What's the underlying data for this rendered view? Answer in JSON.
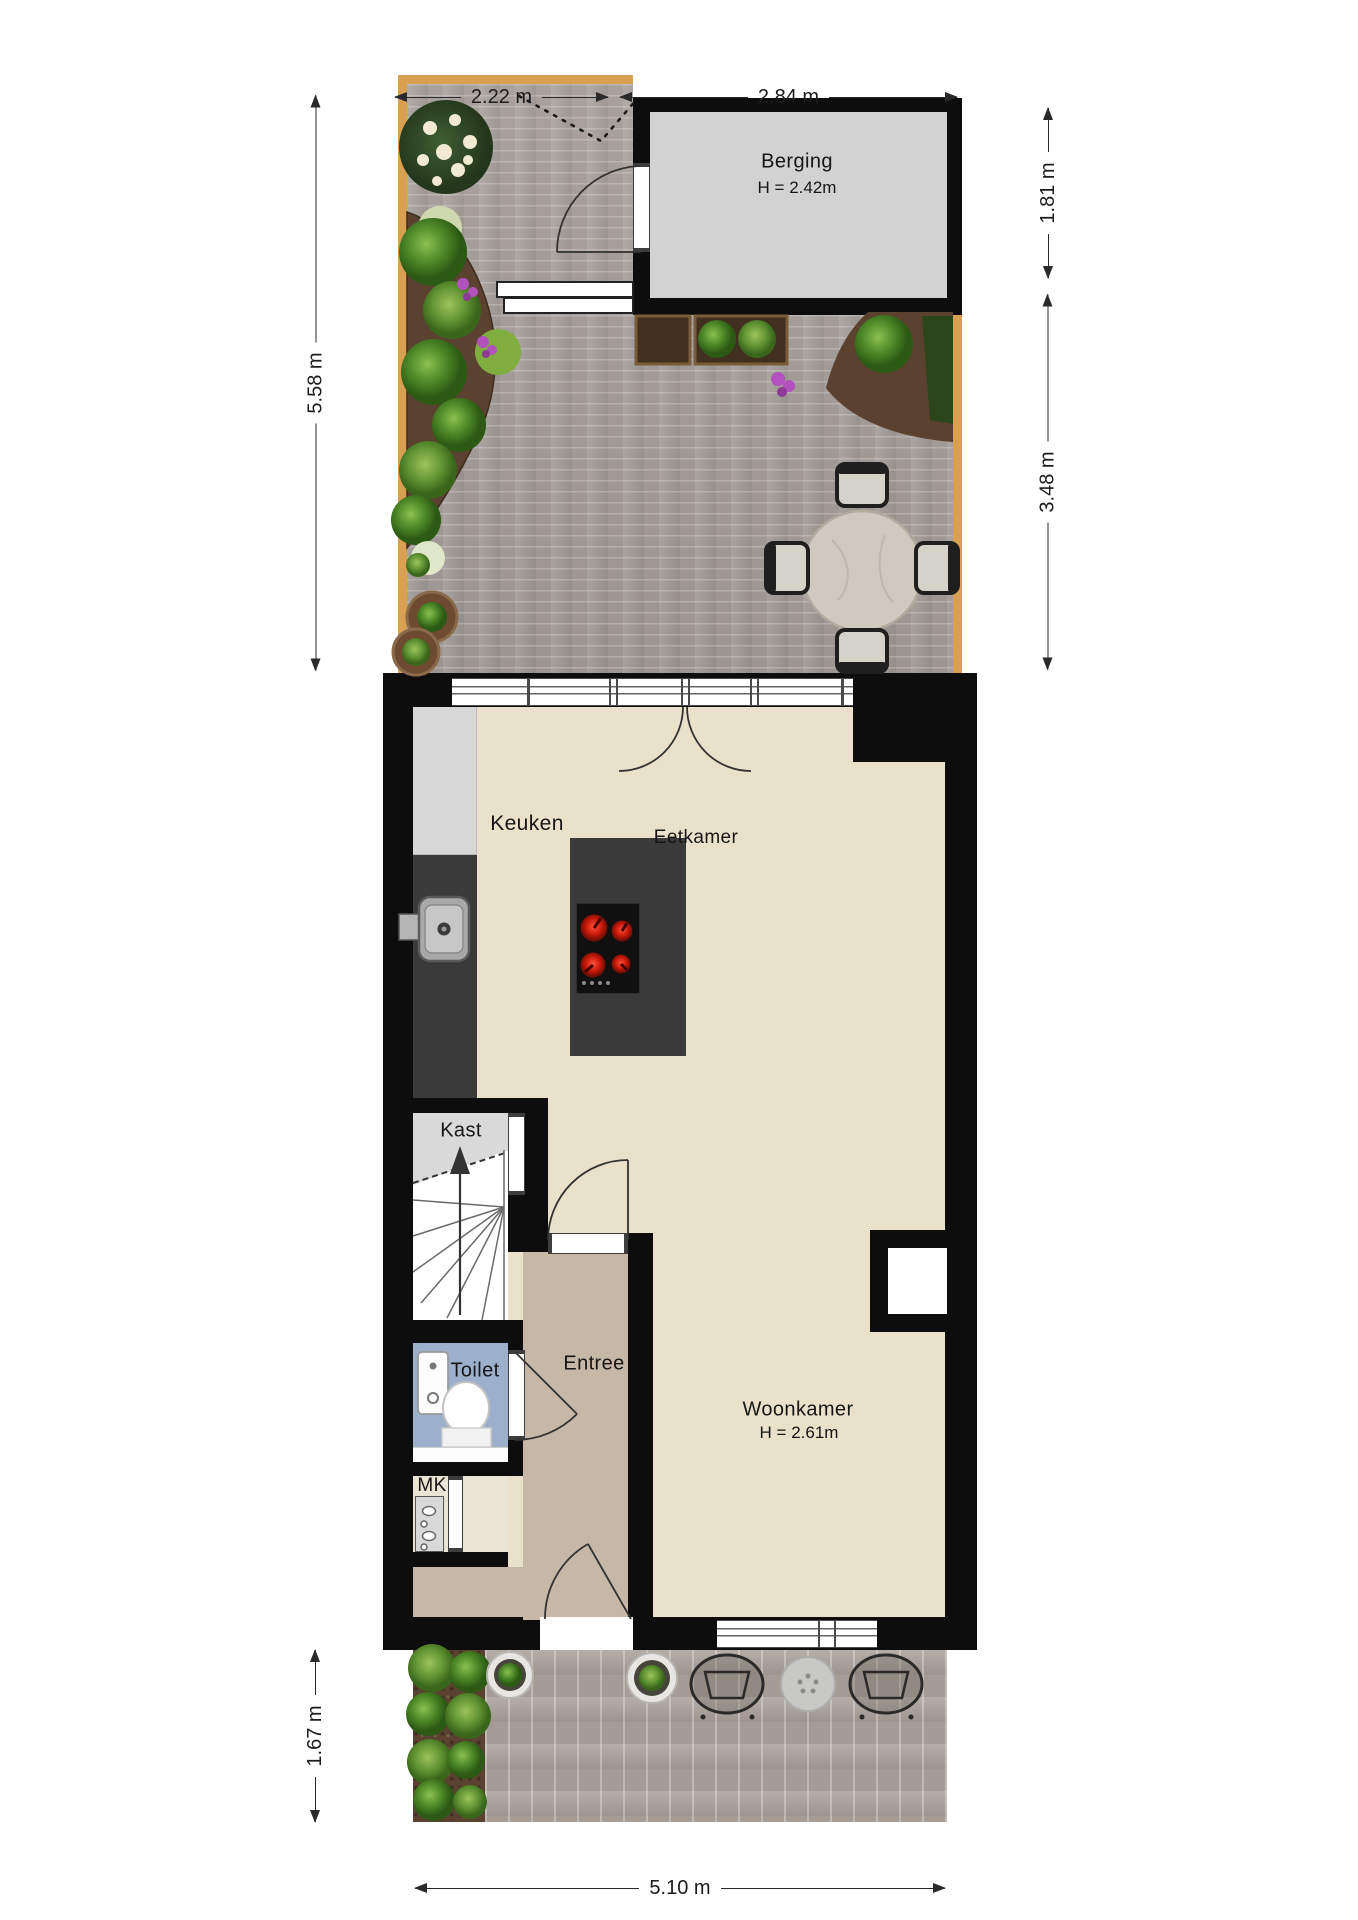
{
  "rooms": {
    "berging": {
      "name": "Berging",
      "ceiling": "H = 2.42m"
    },
    "keuken": {
      "name": "Keuken"
    },
    "eetkamer": {
      "name": "Eetkamer"
    },
    "kast": {
      "name": "Kast"
    },
    "toilet": {
      "name": "Toilet"
    },
    "entree": {
      "name": "Entree"
    },
    "mk": {
      "name": "MK"
    },
    "woonkamer": {
      "name": "Woonkamer",
      "ceiling": "H = 2.61m"
    }
  },
  "dimensions": {
    "garden_width_left": "2.22 m",
    "garden_width_right": "2.84 m",
    "garden_depth": "5.58 m",
    "berging_depth": "1.81 m",
    "garden_lower_depth": "3.48 m",
    "front_garden_depth": "1.67 m",
    "house_width": "5.10 m"
  },
  "objects": {
    "garden": [
      "flower-bush",
      "planting-bed-left",
      "planting-bed-right",
      "hedge",
      "planter-box-soil",
      "planter-box-plants",
      "garden-bench",
      "round-dining-table",
      "garden-chair",
      "potted-plant",
      "shed-door-swing"
    ],
    "house": [
      "kitchen-counter",
      "kitchen-tall-cabinet",
      "kitchen-sink",
      "kitchen-island",
      "cooktop",
      "stairs-up",
      "wash-basin",
      "toilet-bowl",
      "meter-panel",
      "wall-niche",
      "door-swing"
    ],
    "front": [
      "fern-bed",
      "potted-plant",
      "wire-chair",
      "round-side-table",
      "door-step"
    ]
  },
  "colors": {
    "wall": "#0d0d0d",
    "living_floor": "#e9e1c9",
    "entree_floor": "#c7b7a7",
    "toilet_floor": "#9db0cb",
    "kast_floor": "#d9d9d9",
    "berging_floor": "#d2d2d2",
    "counter_dark": "#3a3a3a",
    "garden_paving": "#a49d99",
    "soil": "#5a4130",
    "wood_edge": "#d9a052",
    "burner_red": "#d02818",
    "plant_green": "#4e8a28"
  }
}
